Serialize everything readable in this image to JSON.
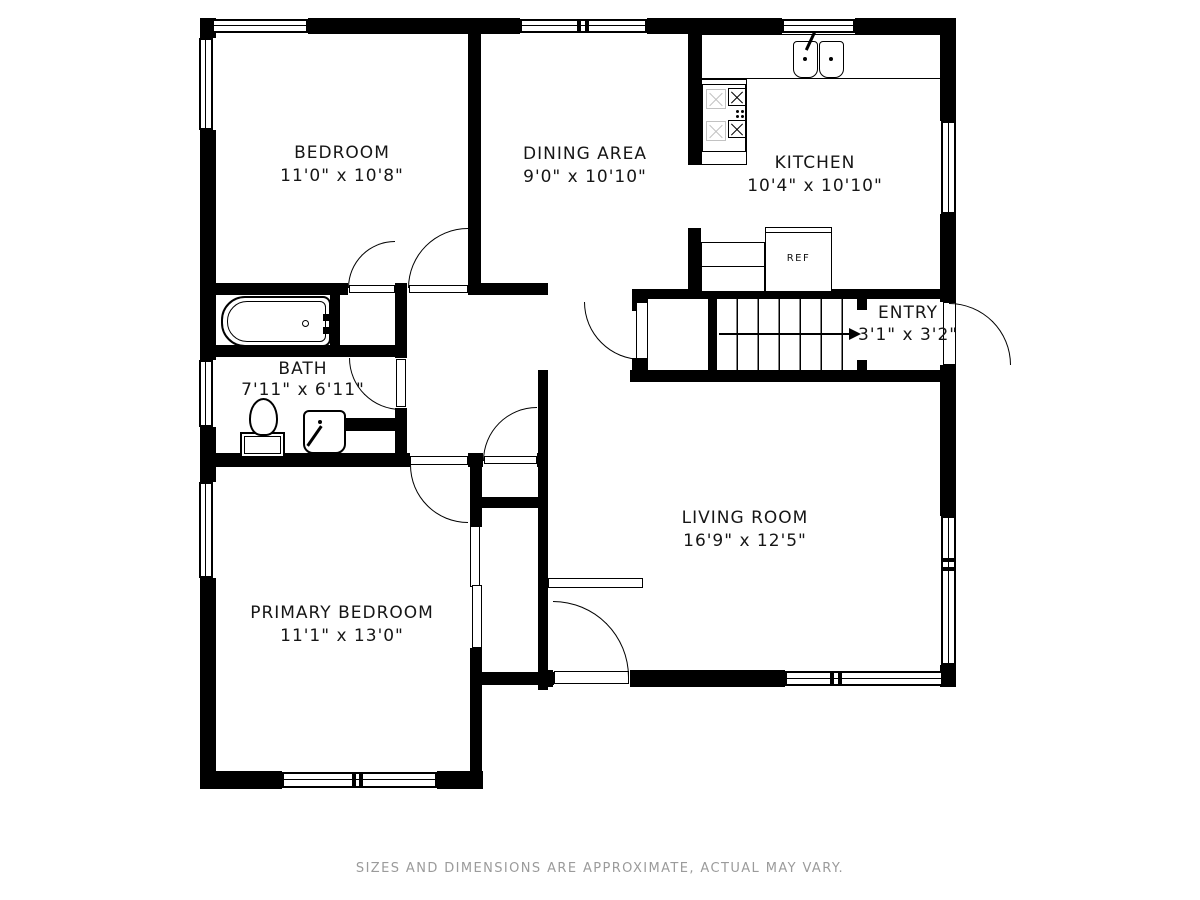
{
  "rooms": [
    {
      "id": "bedroom",
      "name": "BEDROOM",
      "dims": "11'0\" x 10'8\""
    },
    {
      "id": "dining",
      "name": "DINING AREA",
      "dims": "9'0\" x 10'10\""
    },
    {
      "id": "kitchen",
      "name": "KITCHEN",
      "dims": "10'4\" x 10'10\""
    },
    {
      "id": "entry",
      "name": "ENTRY",
      "dims": "3'1\" x 3'2\""
    },
    {
      "id": "bath",
      "name": "BATH",
      "dims": "7'11\" x 6'11\""
    },
    {
      "id": "living",
      "name": "LIVING ROOM",
      "dims": "16'9\" x 12'5\""
    },
    {
      "id": "primary",
      "name": "PRIMARY BEDROOM",
      "dims": "11'1\" x 13'0\""
    }
  ],
  "fixtures": {
    "refrigerator_label": "REF"
  },
  "footer": {
    "disclaimer": "SIZES AND DIMENSIONS ARE APPROXIMATE, ACTUAL MAY VARY."
  },
  "colors": {
    "wall": "#000000",
    "floor": "#ffffff",
    "disclaimer_text": "#9b9b9b",
    "burner_light": "#c2c2c2"
  }
}
